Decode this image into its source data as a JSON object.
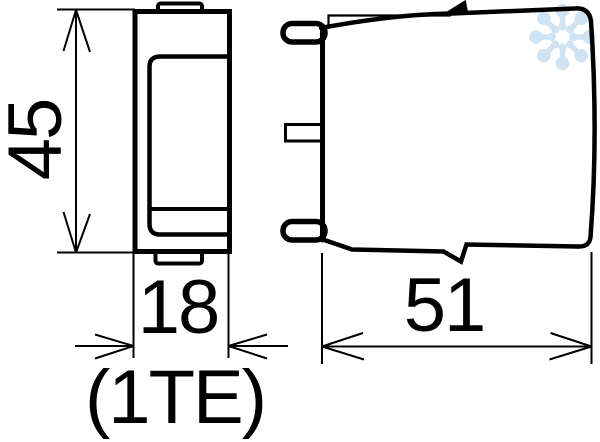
{
  "drawing": {
    "type": "dimensional_drawing",
    "colors": {
      "line": "#000000",
      "background": "#ffffff",
      "watermark": "#cfe3f2"
    },
    "dimension_labels": {
      "height": "45",
      "width": "18",
      "width_note": "(1TE)",
      "depth": "51"
    }
  }
}
